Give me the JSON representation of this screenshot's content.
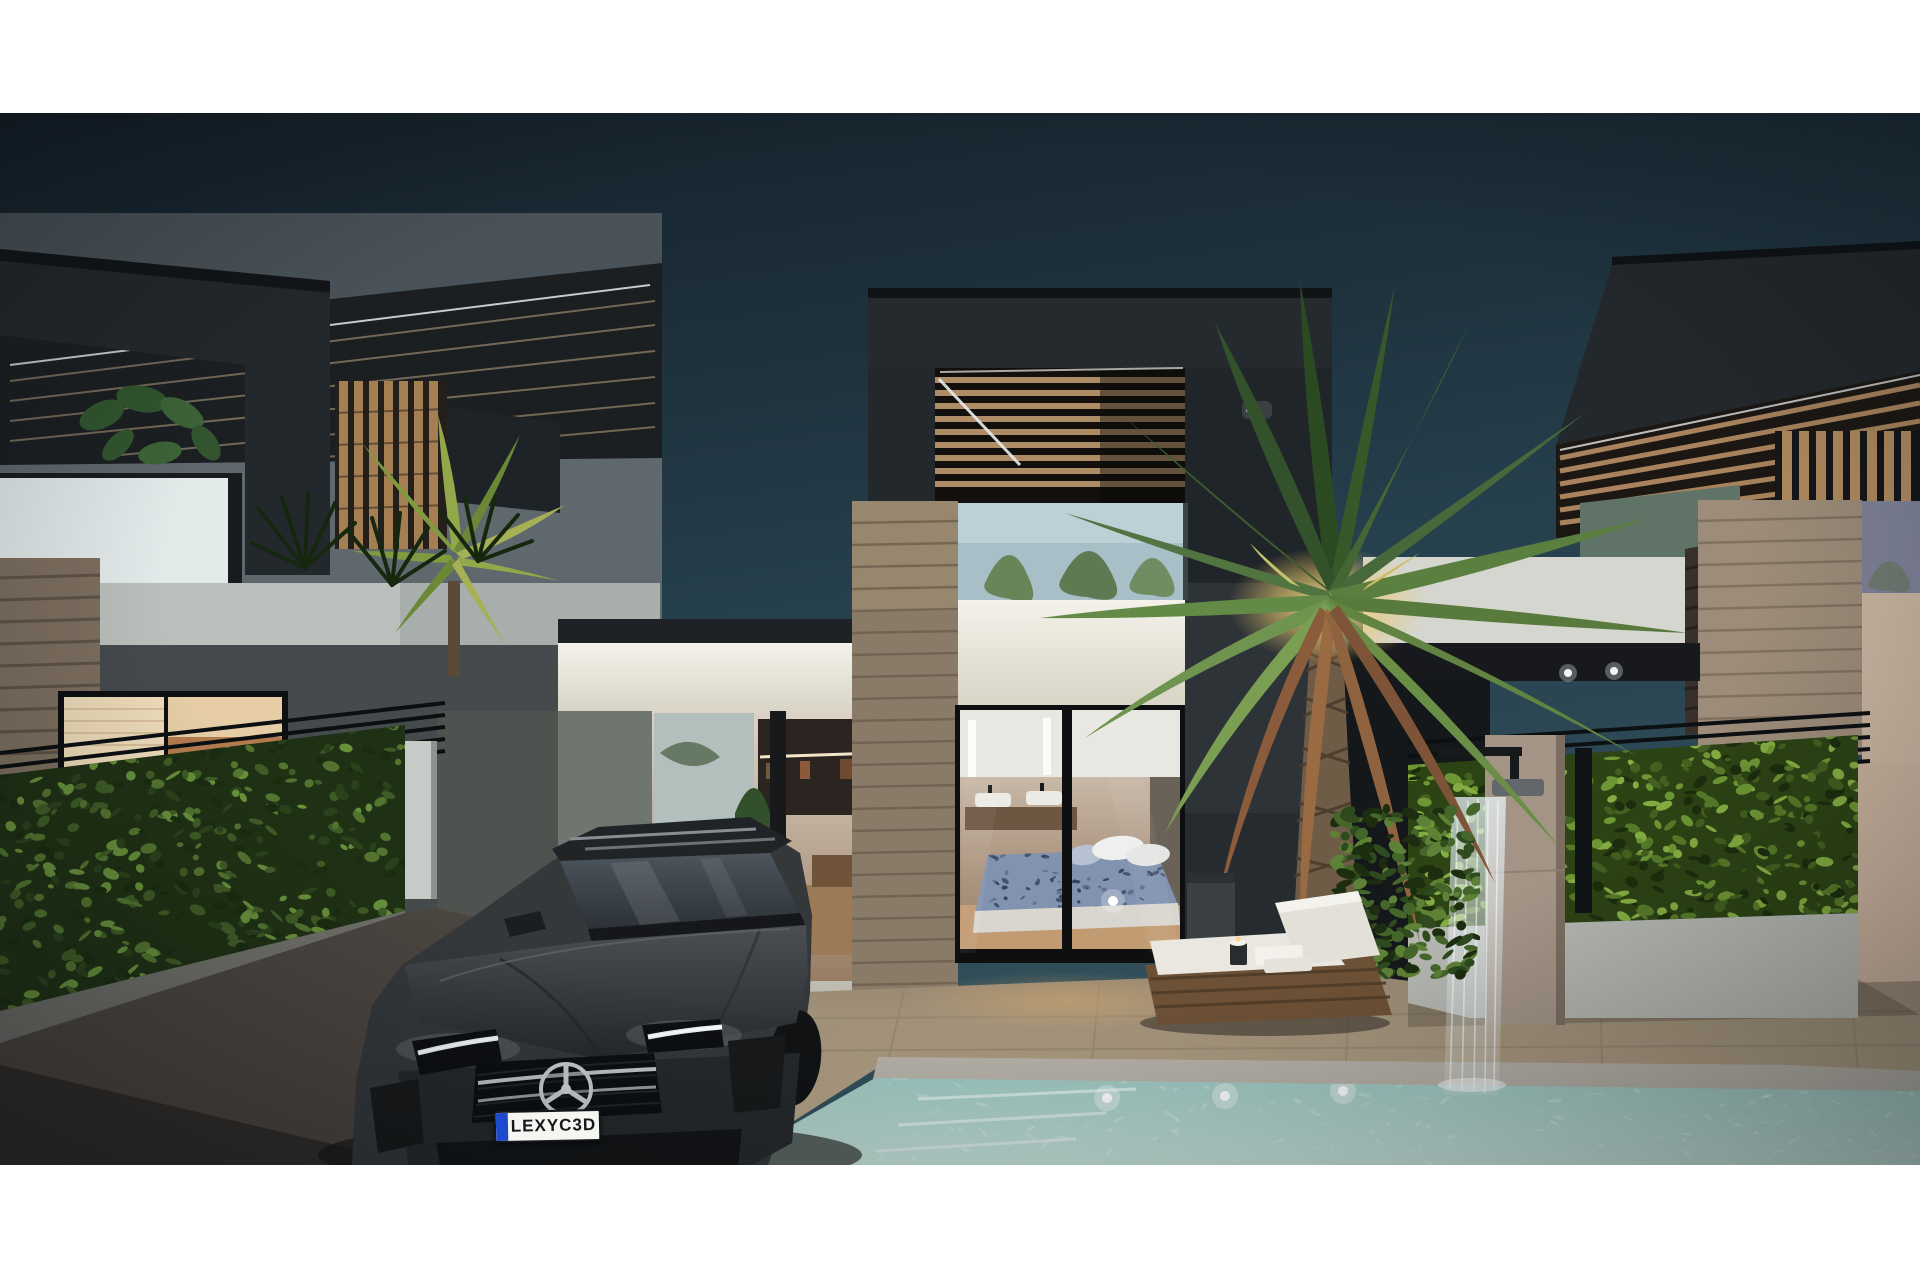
{
  "meta": {
    "kind": "architectural 3d render",
    "description": "Dusk exterior rendering of modern two-storey villas with charcoal pergola roofs, stone pillars, ivy hedge fences, a parked grey Mercedes hatchback, turquoise pool with underwater lights, wicker sun lounger, outdoor shower waterfall and a large up-lit palm tree",
    "time_of_day": "dusk",
    "letterbox_color": "#ffffff"
  },
  "car": {
    "type": "mercedes-hatchback",
    "body_color": "#36393c",
    "license_plate": {
      "text": "LEXYC3D",
      "plate_color": "#f4f6f1",
      "band_color": "#1d49cc",
      "text_color": "#15171a"
    }
  },
  "pool": {
    "underwater_lights": 3,
    "water_color": "#a9d0c9"
  },
  "palette": {
    "sky_top": "#141f28",
    "sky_low": "#33515c",
    "structure_charcoal": "#23282c",
    "pergola_wood": "#ad8c66",
    "white_wall": "#ece9e1",
    "stone_light": "#9d8c79",
    "stone_dark": "#37302b",
    "hedge_green": "#3e5c26",
    "patio_tile": "#ab9d8a",
    "driveway": "#4b4540",
    "crown_uplight": "#e9c96c"
  },
  "objects": [
    "left villa",
    "middle villa with lit living room",
    "center villa with bedroom behind glass doors",
    "right villa",
    "glass balustrade",
    "wood slat pergolas",
    "stone pillars",
    "ivy hedge fences",
    "grey mercedes hatchback",
    "license plate",
    "swimming pool",
    "pool steps",
    "underwater lights",
    "wicker sun lounger",
    "towels",
    "candle",
    "outdoor shower",
    "waterfall",
    "large palm tree",
    "small palm",
    "monstera plant",
    "patio tiles",
    "driveway"
  ]
}
